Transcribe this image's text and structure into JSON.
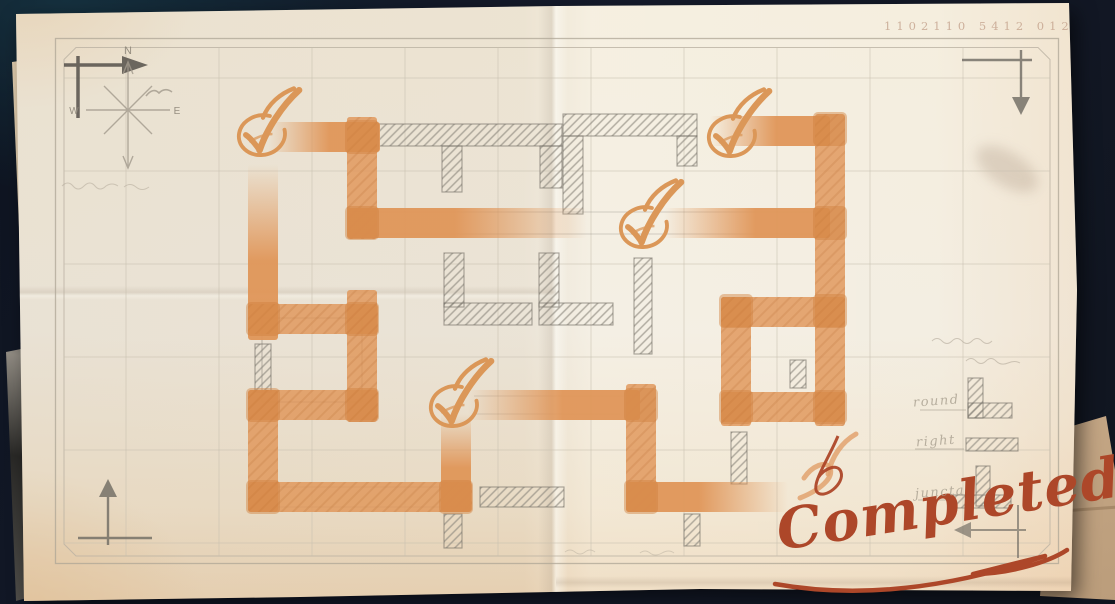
{
  "meta": {
    "serial": "1102110 5412 012"
  },
  "compass": {
    "north": "N",
    "west": "W",
    "east": "E"
  },
  "legend": {
    "rows": [
      {
        "label": "round",
        "symbol": "corner-piece"
      },
      {
        "label": "right",
        "symbol": "straight-piece"
      },
      {
        "label": "juncta",
        "symbol": "junction-piece"
      }
    ]
  },
  "stamp": {
    "text": "Completed",
    "color": "#ad4729"
  },
  "colors": {
    "route": "#e09659",
    "route_joint": "#d0813f",
    "pencil": "#6f6b63",
    "pencil_hatch": "#8d887e",
    "grid": "#c7bfae",
    "check": "#db9758",
    "paper": "#f0eade",
    "background": "#131a29"
  },
  "maze": {
    "grid": {
      "vx": [
        126,
        219,
        312,
        405,
        498,
        591,
        684,
        777,
        870,
        963
      ],
      "hy": [
        78,
        171,
        264,
        357,
        450,
        543
      ],
      "x0": 64,
      "y0": 47,
      "x1": 1050,
      "y1": 556
    },
    "orange_segments": [
      {
        "x": 268,
        "y": 122,
        "w": 112,
        "h": 30,
        "fade": "left"
      },
      {
        "x": 347,
        "y": 117,
        "w": 30,
        "h": 122,
        "fade": null
      },
      {
        "x": 347,
        "y": 208,
        "w": 240,
        "h": 30,
        "fade": "right"
      },
      {
        "x": 664,
        "y": 208,
        "w": 166,
        "h": 30,
        "fade": "left"
      },
      {
        "x": 710,
        "y": 116,
        "w": 120,
        "h": 30,
        "fade": "left"
      },
      {
        "x": 815,
        "y": 114,
        "w": 30,
        "h": 312,
        "fade": null
      },
      {
        "x": 721,
        "y": 297,
        "w": 124,
        "h": 30,
        "fade": null
      },
      {
        "x": 721,
        "y": 297,
        "w": 30,
        "h": 129,
        "fade": null
      },
      {
        "x": 721,
        "y": 392,
        "w": 124,
        "h": 30,
        "fade": null
      },
      {
        "x": 626,
        "y": 384,
        "w": 30,
        "h": 128,
        "fade": null
      },
      {
        "x": 626,
        "y": 482,
        "w": 162,
        "h": 30,
        "fade": "right"
      },
      {
        "x": 468,
        "y": 390,
        "w": 172,
        "h": 30,
        "fade": "left"
      },
      {
        "x": 248,
        "y": 164,
        "w": 30,
        "h": 176,
        "fade": "top"
      },
      {
        "x": 248,
        "y": 304,
        "w": 130,
        "h": 30,
        "fade": null
      },
      {
        "x": 347,
        "y": 290,
        "w": 30,
        "h": 132,
        "fade": null
      },
      {
        "x": 248,
        "y": 390,
        "w": 130,
        "h": 30,
        "fade": null
      },
      {
        "x": 248,
        "y": 390,
        "w": 30,
        "h": 122,
        "fade": null
      },
      {
        "x": 248,
        "y": 482,
        "w": 224,
        "h": 30,
        "fade": null
      },
      {
        "x": 441,
        "y": 414,
        "w": 30,
        "h": 98,
        "fade": "top"
      }
    ],
    "joints": [
      [
        345,
        120
      ],
      [
        345,
        206
      ],
      [
        813,
        112
      ],
      [
        813,
        206
      ],
      [
        719,
        294
      ],
      [
        813,
        294
      ],
      [
        719,
        390
      ],
      [
        813,
        390
      ],
      [
        624,
        388
      ],
      [
        624,
        480
      ],
      [
        246,
        302
      ],
      [
        345,
        302
      ],
      [
        345,
        388
      ],
      [
        246,
        388
      ],
      [
        246,
        480
      ],
      [
        439,
        480
      ]
    ],
    "pencil_segments": [
      [
        378,
        124,
        184,
        22
      ],
      [
        442,
        146,
        20,
        46
      ],
      [
        540,
        146,
        22,
        42
      ],
      [
        563,
        114,
        134,
        22
      ],
      [
        563,
        136,
        20,
        78
      ],
      [
        677,
        136,
        20,
        30
      ],
      [
        444,
        253,
        20,
        54
      ],
      [
        444,
        303,
        88,
        22
      ],
      [
        539,
        253,
        20,
        54
      ],
      [
        539,
        303,
        74,
        22
      ],
      [
        634,
        258,
        18,
        96
      ],
      [
        480,
        487,
        84,
        20
      ],
      [
        444,
        514,
        18,
        34
      ],
      [
        684,
        514,
        16,
        32
      ],
      [
        731,
        432,
        16,
        52
      ],
      [
        790,
        360,
        16,
        28
      ],
      [
        255,
        344,
        16,
        48
      ],
      [
        968,
        378,
        15,
        40
      ],
      [
        968,
        403,
        44,
        15
      ],
      [
        966,
        438,
        52,
        13
      ],
      [
        953,
        495,
        58,
        13
      ],
      [
        976,
        466,
        14,
        40
      ]
    ],
    "checkmarks": [
      [
        263,
        128
      ],
      [
        733,
        129
      ],
      [
        645,
        220
      ],
      [
        455,
        399
      ]
    ]
  }
}
